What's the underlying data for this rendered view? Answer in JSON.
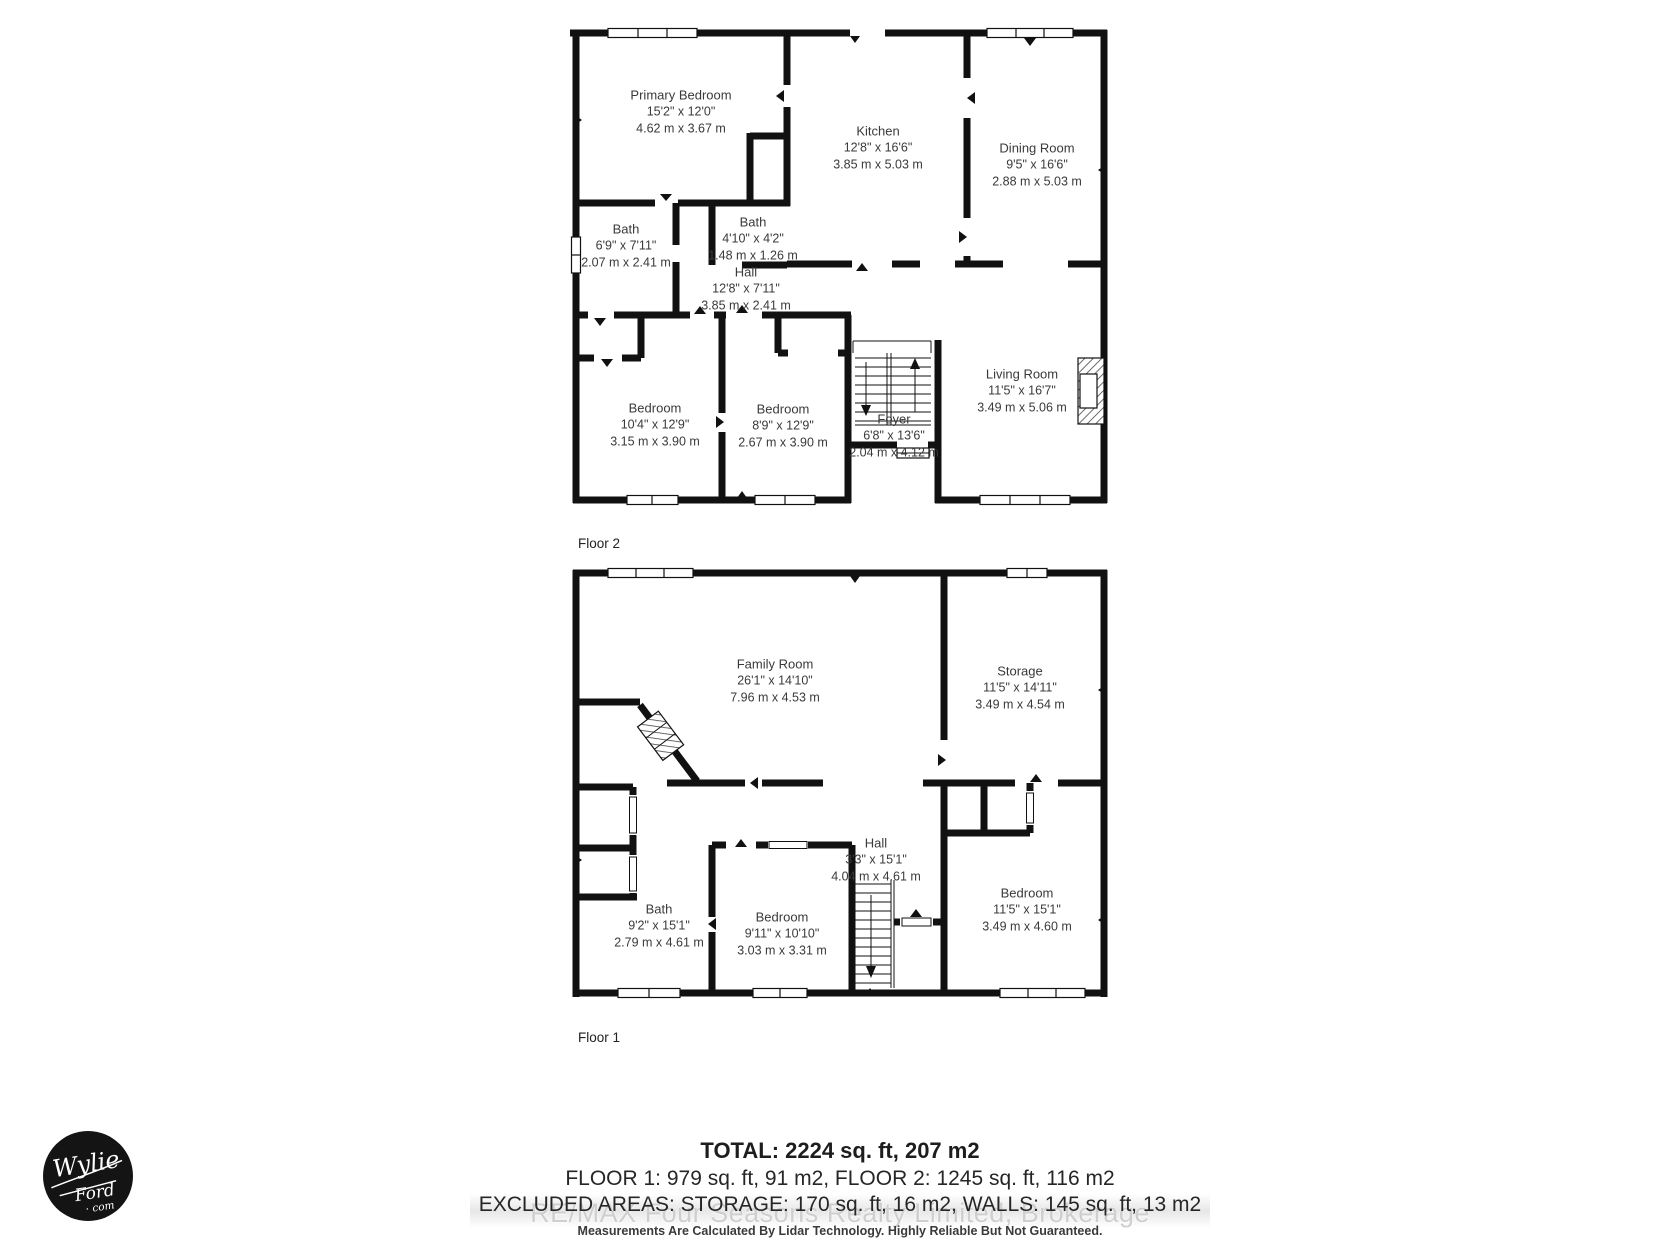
{
  "floor2": {
    "label": "Floor 2",
    "rooms": {
      "primary_bedroom": {
        "name": "Primary Bedroom",
        "imperial": "15'2\" x 12'0\"",
        "metric": "4.62 m x 3.67 m"
      },
      "kitchen": {
        "name": "Kitchen",
        "imperial": "12'8\" x 16'6\"",
        "metric": "3.85 m x 5.03 m"
      },
      "dining_room": {
        "name": "Dining Room",
        "imperial": "9'5\" x 16'6\"",
        "metric": "2.88 m x 5.03 m"
      },
      "bath_main": {
        "name": "Bath",
        "imperial": "6'9\" x 7'11\"",
        "metric": "2.07 m x 2.41 m"
      },
      "bath_small": {
        "name": "Bath",
        "imperial": "4'10\" x 4'2\"",
        "metric": "1.48 m x 1.26 m"
      },
      "hall": {
        "name": "Hall",
        "imperial": "12'8\" x 7'11\"",
        "metric": "3.85 m x 2.41 m"
      },
      "bedroom_left": {
        "name": "Bedroom",
        "imperial": "10'4\" x 12'9\"",
        "metric": "3.15 m x 3.90 m"
      },
      "bedroom_middle": {
        "name": "Bedroom",
        "imperial": "8'9\" x 12'9\"",
        "metric": "2.67 m x 3.90 m"
      },
      "foyer": {
        "name": "Foyer",
        "imperial": "6'8\" x 13'6\"",
        "metric": "2.04 m x 4.12 m"
      },
      "living_room": {
        "name": "Living Room",
        "imperial": "11'5\" x 16'7\"",
        "metric": "3.49 m x 5.06 m"
      }
    }
  },
  "floor1": {
    "label": "Floor 1",
    "rooms": {
      "family_room": {
        "name": "Family Room",
        "imperial": "26'1\" x 14'10\"",
        "metric": "7.96 m x 4.53 m"
      },
      "storage": {
        "name": "Storage",
        "imperial": "11'5\" x 14'11\"",
        "metric": "3.49 m x 4.54 m"
      },
      "hall": {
        "name": "Hall",
        "imperial": "3'3\" x 15'1\"",
        "metric": "4.04 m x 4.61 m"
      },
      "bath": {
        "name": "Bath",
        "imperial": "9'2\" x 15'1\"",
        "metric": "2.79 m x 4.61 m"
      },
      "bedroom_middle": {
        "name": "Bedroom",
        "imperial": "9'11\" x 10'10\"",
        "metric": "3.03 m x 3.31 m"
      },
      "bedroom_right": {
        "name": "Bedroom",
        "imperial": "11'5\" x 15'1\"",
        "metric": "3.49 m x 4.60 m"
      }
    }
  },
  "summary": {
    "total": "TOTAL: 2224 sq. ft, 207 m2",
    "floors_line": "FLOOR 1: 979 sq. ft, 91 m2, FLOOR 2: 1245 sq. ft, 116 m2",
    "excluded_line": "EXCLUDED AREAS: STORAGE: 170 sq. ft, 16 m2, WALLS: 145 sq. ft, 13 m2",
    "watermark": "RE/MAX Four Seasons Realty Limited, Brokerage",
    "disclaimer": "Measurements Are Calculated By Lidar Technology. Highly Reliable But Not Guaranteed."
  },
  "logo": {
    "line1": "Wylie",
    "line2": "Ford",
    "line3": "· com"
  },
  "colors": {
    "wall": "#111111",
    "label_text": "#3a3a3a",
    "watermark": "#cfcfcf"
  }
}
